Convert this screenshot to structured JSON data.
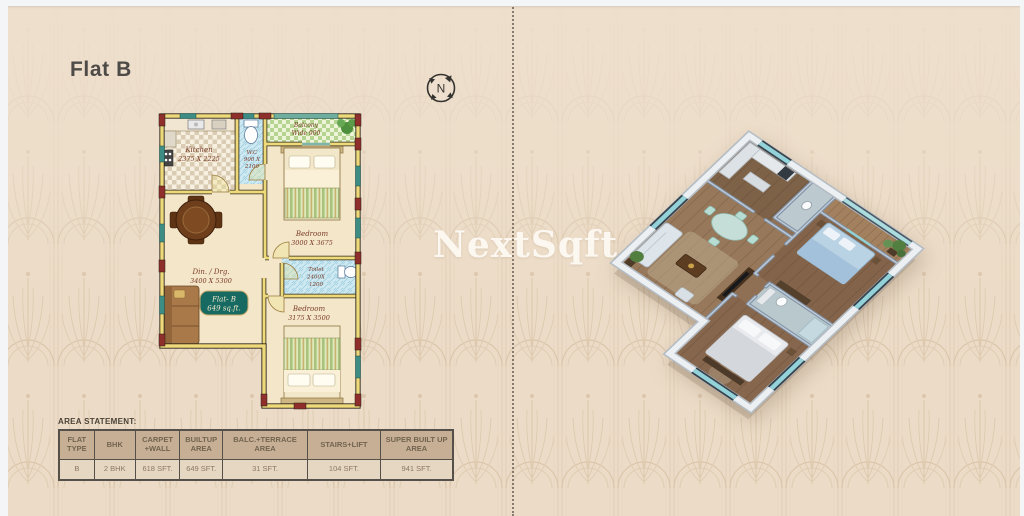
{
  "page": {
    "title": "Flat B",
    "watermark": "NextSqft",
    "compass": "N"
  },
  "floor_plan": {
    "rooms": {
      "kitchen": {
        "name": "Kitchen",
        "dim": "2375 X 2225"
      },
      "wc": {
        "name": "W.C",
        "dim1": "900 X",
        "dim2": "2100"
      },
      "balcony": {
        "name": "Balcony",
        "dim": "Wide 900"
      },
      "bedroom1": {
        "name": "Bedroom",
        "dim": "3000 X 3675"
      },
      "dining": {
        "name": "Din. / Drg.",
        "dim": "3400 X 5300"
      },
      "toilet": {
        "name": "Toilet",
        "dim1": "2400X",
        "dim2": "1200"
      },
      "bedroom2": {
        "name": "Bedroom",
        "dim": "3175 X 3500"
      }
    },
    "badge": {
      "line1": "Flat- B",
      "line2": "649 sq.ft."
    }
  },
  "area_statement": {
    "label": "AREA STATEMENT:",
    "headers": [
      "FLAT TYPE",
      "BHK",
      "CARPET +WALL",
      "BUILTUP AREA",
      "BALC.+TERRACE AREA",
      "STAIRS+LIFT",
      "SUPER BUILT UP AREA"
    ],
    "rows": [
      [
        "B",
        "2 BHK",
        "618 SFT.",
        "649 SFT.",
        "31 SFT.",
        "104 SFT.",
        "941 SFT."
      ]
    ]
  },
  "colors": {
    "background": "#ecdcc7",
    "pattern_line": "#d6c0a8",
    "wall_yellow": "#eeda7a",
    "wall_block_maroon": "#8f2f2b",
    "window_teal": "#3d8d85",
    "badge_teal": "#176a62",
    "table_header_bg": "#c7af95",
    "watermark_white": "#fdfaf3"
  }
}
